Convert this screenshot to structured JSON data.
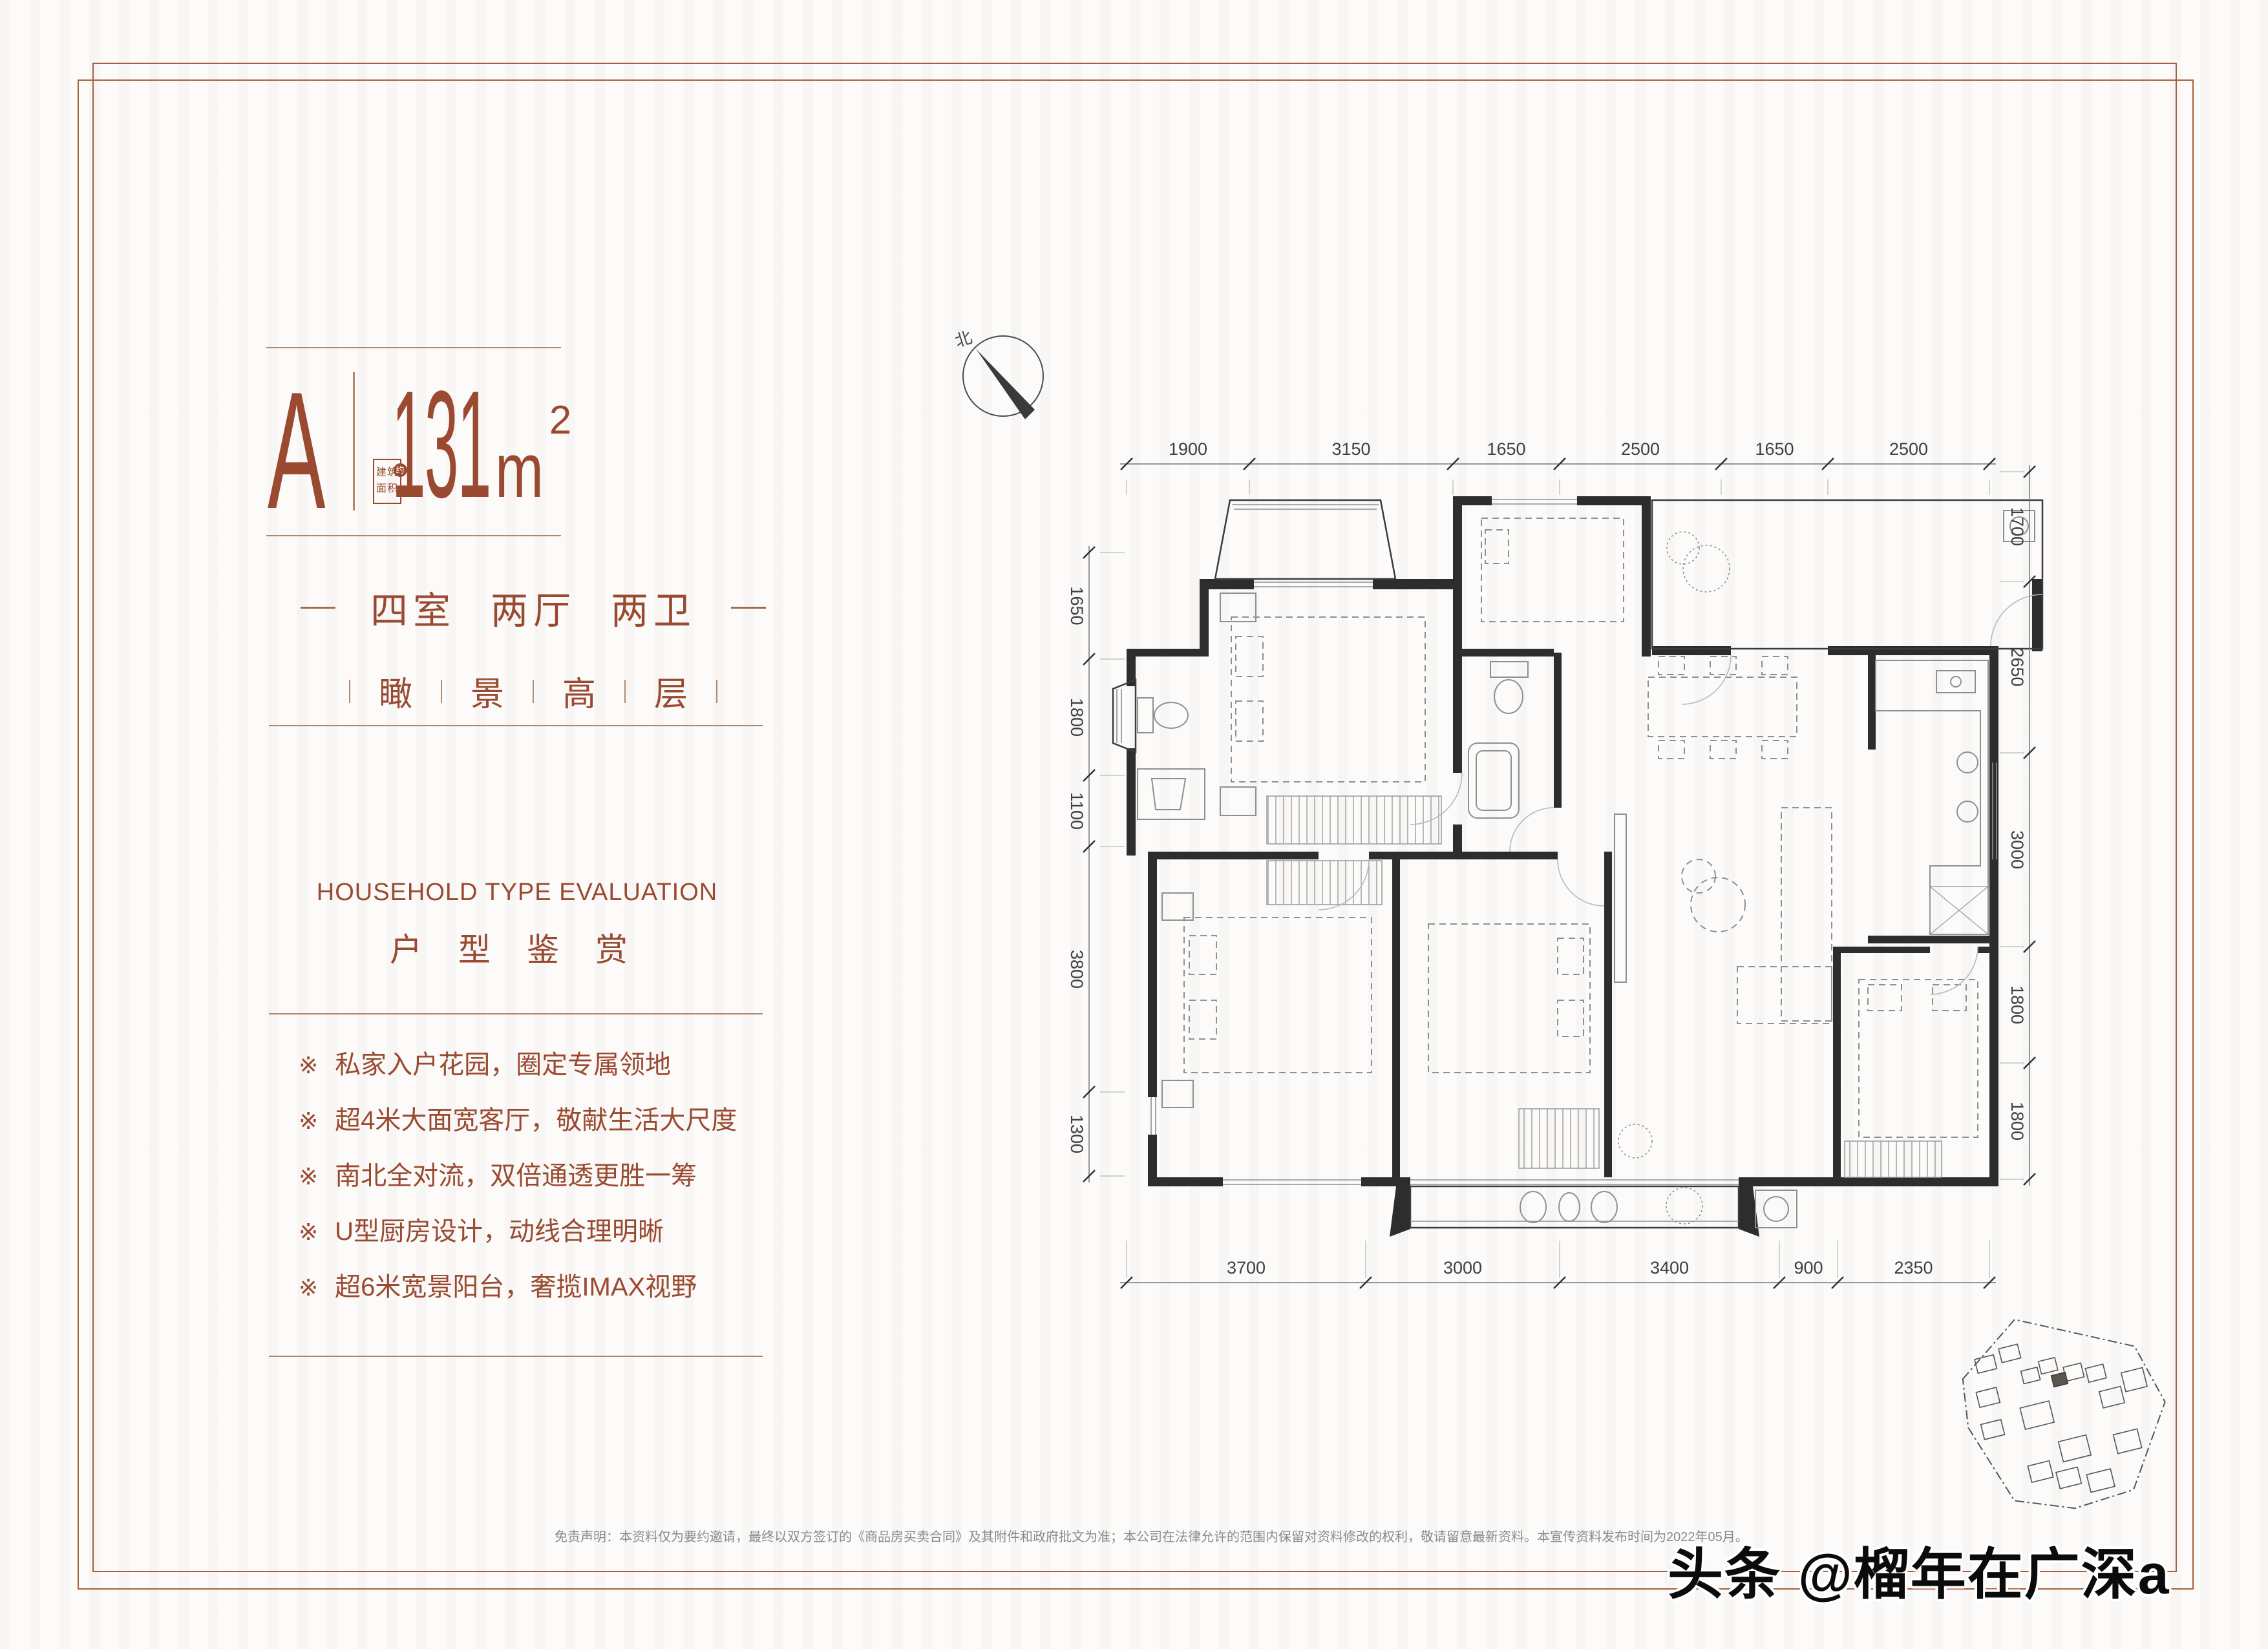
{
  "accent_color": "#9a4a30",
  "frame_color": "#a5613c",
  "unit": {
    "letter": "A",
    "area_value": "131",
    "area_unit": "m",
    "area_exp": "2",
    "area_label_line1": "建筑",
    "area_label_line2": "面积",
    "area_approx": "约"
  },
  "headline": {
    "rooms": [
      "四室",
      "两厅",
      "两卫"
    ],
    "features": [
      "瞰",
      "景",
      "高",
      "层"
    ]
  },
  "section": {
    "title_en": "HOUSEHOLD TYPE EVALUATION",
    "title_cn": "户型鉴赏"
  },
  "bullets": [
    {
      "marker": "※",
      "text": "私家入户花园，圈定专属领地"
    },
    {
      "marker": "※",
      "text": "超4米大面宽客厅，敬献生活大尺度"
    },
    {
      "marker": "※",
      "text": "南北全对流，双倍通透更胜一筹"
    },
    {
      "marker": "※",
      "text": "U型厨房设计，动线合理明晰"
    },
    {
      "marker": "※",
      "text": "超6米宽景阳台，奢揽IMAX视野"
    }
  ],
  "floor_plan": {
    "compass_label": "北",
    "dimensions_mm": {
      "top": [
        1900,
        3150,
        1650,
        2500,
        1650,
        2500
      ],
      "right": [
        1700,
        2650,
        3000,
        1800,
        1800
      ],
      "left": [
        1650,
        1800,
        1100,
        3800,
        1300
      ],
      "bottom": [
        3700,
        3000,
        3400,
        900,
        2350
      ]
    }
  },
  "footer": {
    "disclaimer": "免责声明：本资料仅为要约邀请，最终以双方签订的《商品房买卖合同》及其附件和政府批文为准；本公司在法律允许的范围内保留对资料修改的权利，敬请留意最新资料。本宣传资料发布时间为2022年05月。",
    "watermark": "头条 @榴年在广深a"
  }
}
